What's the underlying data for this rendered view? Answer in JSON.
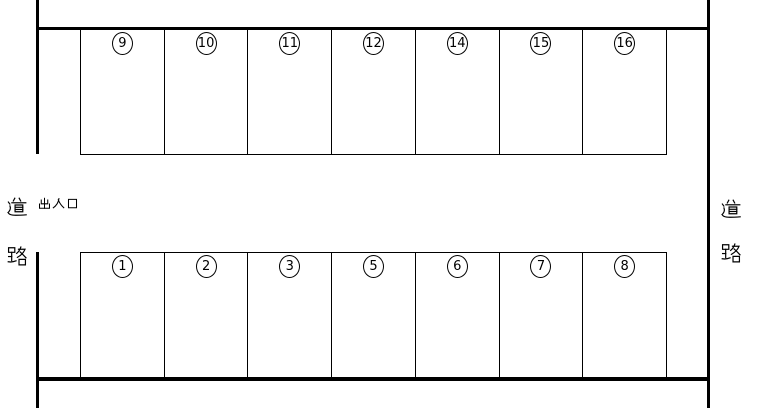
{
  "road_label_left": "道路",
  "road_label_right": "道路",
  "entrance_label": "出入口",
  "rows": {
    "top": {
      "spaces": [
        "9",
        "10",
        "11",
        "12",
        "14",
        "15",
        "16"
      ]
    },
    "bottom": {
      "spaces": [
        "1",
        "2",
        "3",
        "5",
        "6",
        "7",
        "8"
      ]
    }
  },
  "colors": {
    "line": "#000000",
    "background": "#ffffff"
  }
}
